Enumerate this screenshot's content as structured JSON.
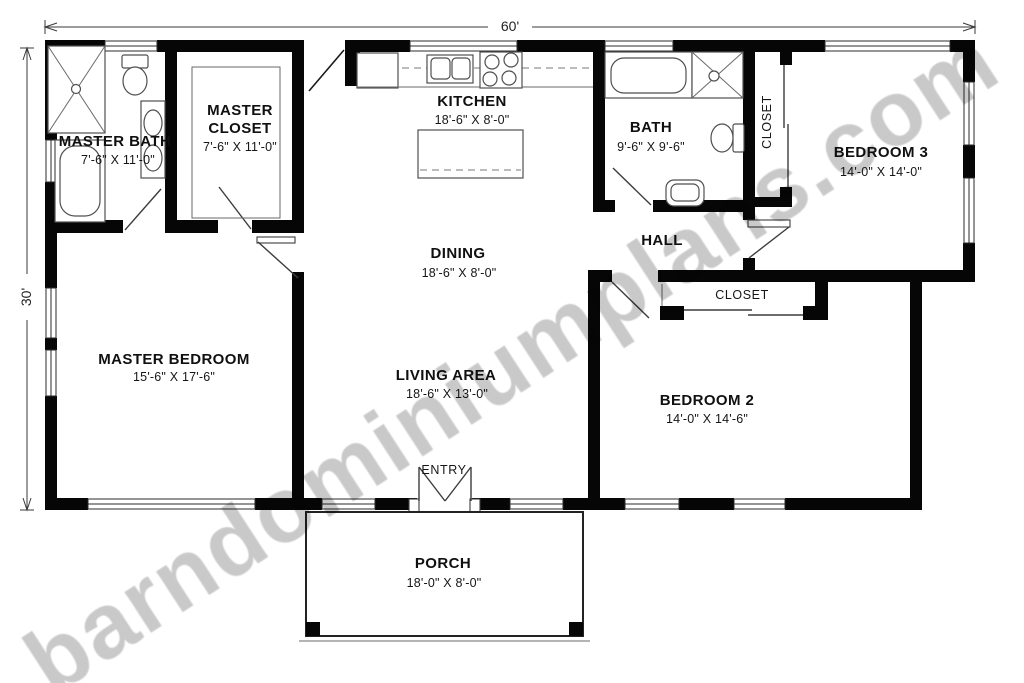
{
  "watermark": "barndominiumplans.com",
  "plan": {
    "overall_width": "60'",
    "overall_depth": "30'"
  },
  "rooms": {
    "master_bath": {
      "name": "MASTER BATH",
      "dims": "7'-6\" X 11'-0\""
    },
    "master_closet": {
      "name_line1": "MASTER",
      "name_line2": "CLOSET",
      "dims": "7'-6\" X 11'-0\""
    },
    "kitchen": {
      "name": "KITCHEN",
      "dims": "18'-6\" X 8'-0\""
    },
    "bath": {
      "name": "BATH",
      "dims": "9'-6\" X 9'-6\""
    },
    "hall_closet": {
      "name": "CLOSET"
    },
    "bedroom3": {
      "name": "BEDROOM 3",
      "dims": "14'-0\" X 14'-0\""
    },
    "dining": {
      "name": "DINING",
      "dims": "18'-6\" X 8'-0\""
    },
    "hall": {
      "name": "HALL"
    },
    "bedroom2_closet": {
      "name": "CLOSET"
    },
    "master_bedroom": {
      "name": "MASTER BEDROOM",
      "dims": "15'-6\" X 17'-6\""
    },
    "living_area": {
      "name": "LIVING AREA",
      "dims": "18'-6\" X 13'-0\""
    },
    "entry": {
      "name": "ENTRY"
    },
    "bedroom2": {
      "name": "BEDROOM 2",
      "dims": "14'-0\" X 14'-6\""
    },
    "porch": {
      "name": "PORCH",
      "dims": "18'-0\" X 8'-0\""
    }
  }
}
